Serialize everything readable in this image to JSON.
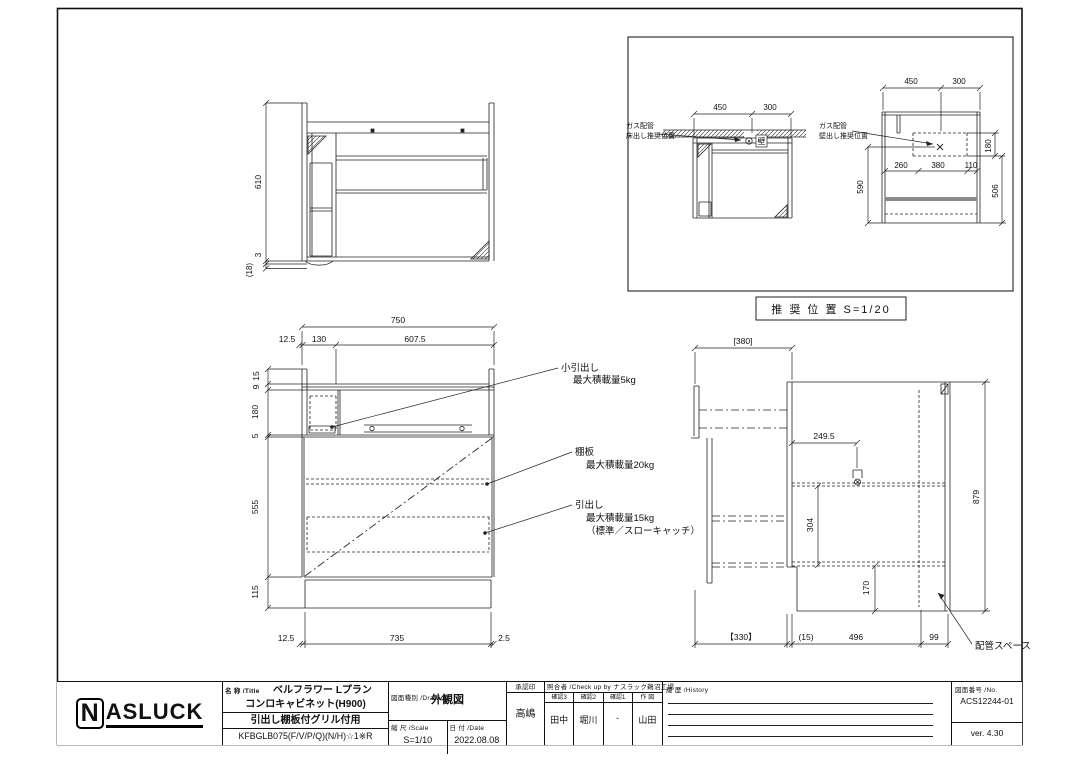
{
  "plan_view": {
    "d610": "610",
    "d3": "3",
    "d18": "(18)"
  },
  "front_view": {
    "d750": "750",
    "d12_5_top": "12.5",
    "d130": "130",
    "d607_5": "607.5",
    "d15": "15",
    "d9": "9",
    "d180": "180",
    "d5": "5",
    "d555": "555",
    "d115": "115",
    "d12_5_bottom": "12.5",
    "d735": "735",
    "d2_5": "2.5",
    "ann_small_drawer_1": "小引出し",
    "ann_small_drawer_2": "最大積載量5kg",
    "ann_shelf_1": "棚板",
    "ann_shelf_2": "最大積載量20kg",
    "ann_drawer_1": "引出し",
    "ann_drawer_2": "最大積載量15kg",
    "ann_drawer_3": "（標準／スローキャッチ）"
  },
  "side_view": {
    "d380": "[380]",
    "d249_5": "249.5",
    "d304": "304",
    "d170": "170",
    "d879": "879",
    "d330": "【330】",
    "d15p": "(15)",
    "d496": "496",
    "d99": "99",
    "ann_piping": "配管スペース"
  },
  "inset": {
    "caption": "推 奨 位 置  S=1/20",
    "floor_view": {
      "label_1": "ガス配管",
      "label_2": "床出し推奨位置",
      "wall_mark": "壁",
      "d450": "450",
      "d300": "300"
    },
    "wall_view": {
      "label_1": "ガス配管",
      "label_2": "壁出し推奨位置",
      "d450": "450",
      "d300": "300",
      "d260": "260",
      "d380": "380",
      "d110": "110",
      "d180": "180",
      "d590": "590",
      "d506": "506"
    }
  },
  "title_block": {
    "logo_n": "N",
    "logo_rest": "ASLUCK",
    "name_label": "名 称 /Title",
    "title_line1": "ベルフラワー  Lプラン",
    "title_line2": "コンロキャビネット(H900)",
    "title_line3": "引出し棚板付グリル付用",
    "title_line4": "KFBGLB075(F/V/P/Q)(N/H)☆1※R",
    "drawing_label": "図面種別 /Drawing",
    "drawing_type": "外観図",
    "scale_label": "縮 尺 /Scale",
    "scale_value": "S=1/10",
    "date_label": "日 付 /Date",
    "date_value": "2022.08.08",
    "approval_label": "承認印",
    "approval_value": "高嶋",
    "check_label": "照合者 /Check up by ナスラック鵜沼工場",
    "check_cols": [
      {
        "label": "確認3",
        "value": "田中"
      },
      {
        "label": "確認2",
        "value": "堀川"
      },
      {
        "label": "確認1",
        "value": "-"
      },
      {
        "label": "作 図",
        "value": "山田"
      }
    ],
    "history_label": "履 歴 /History",
    "no_label": "図面番号 /No.",
    "drawing_no": "ACS12244-01",
    "version": "ver. 4.30"
  }
}
